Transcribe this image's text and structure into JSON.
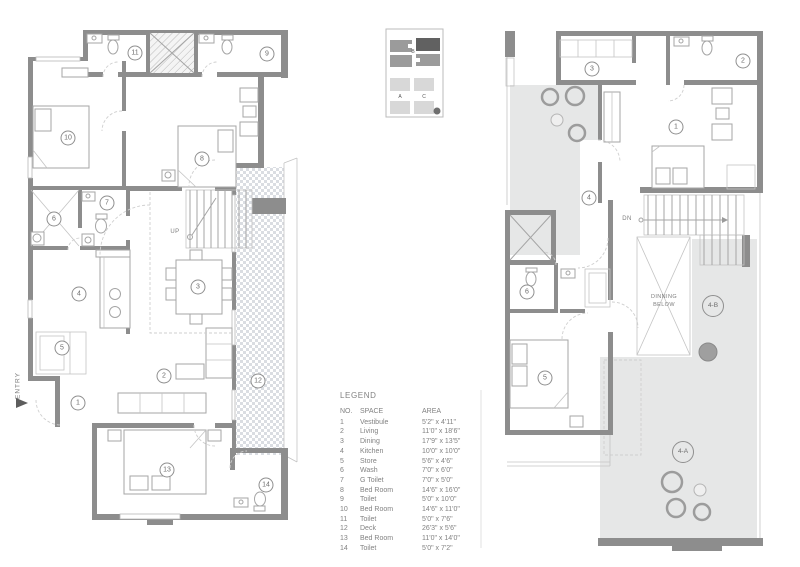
{
  "key_plan": {
    "block_top_label": "B",
    "block_left_label": "A",
    "block_right_label": "C"
  },
  "legend": {
    "title": "LEGEND",
    "col_no": "NO.",
    "col_space": "SPACE",
    "col_area": "AREA",
    "rows": [
      {
        "no": "1",
        "space": "Vestibule",
        "area": "5'2\" x 4'11\""
      },
      {
        "no": "2",
        "space": "Living",
        "area": "11'0\" x 18'6\""
      },
      {
        "no": "3",
        "space": "Dining",
        "area": "17'9\" x 13'5\""
      },
      {
        "no": "4",
        "space": "Kitchen",
        "area": "10'0\" x 10'0\""
      },
      {
        "no": "5",
        "space": "Store",
        "area": "5'6\" x 4'6\""
      },
      {
        "no": "6",
        "space": "Wash",
        "area": "7'0\" x 6'0\""
      },
      {
        "no": "7",
        "space": "G Toilet",
        "area": "7'0\" x 5'0\""
      },
      {
        "no": "8",
        "space": "Bed Room",
        "area": "14'6\" x 16'0\""
      },
      {
        "no": "9",
        "space": "Toilet",
        "area": "5'0\" x 10'0\""
      },
      {
        "no": "10",
        "space": "Bed Room",
        "area": "14'6\" x 11'0\""
      },
      {
        "no": "11",
        "space": "Toilet",
        "area": "5'0\" x 7'6\""
      },
      {
        "no": "12",
        "space": "Deck",
        "area": "26'3\" x 5'6\""
      },
      {
        "no": "13",
        "space": "Bed Room",
        "area": "11'0\" x 14'0\""
      },
      {
        "no": "14",
        "space": "Toilet",
        "area": "5'0\" x 7'2\""
      }
    ]
  },
  "plans": {
    "left": {
      "entry": "ENTRY",
      "stair": "UP",
      "rooms": [
        "1",
        "2",
        "3",
        "4",
        "5",
        "6",
        "7",
        "8",
        "9",
        "10",
        "11",
        "12",
        "13",
        "14"
      ]
    },
    "right": {
      "stair": "DN",
      "void_line1": "DINNING",
      "void_line2": "BELOW",
      "unit_b": "4-B",
      "unit_a": "4-A",
      "rooms": [
        "1",
        "2",
        "3",
        "4",
        "5",
        "6"
      ]
    }
  }
}
